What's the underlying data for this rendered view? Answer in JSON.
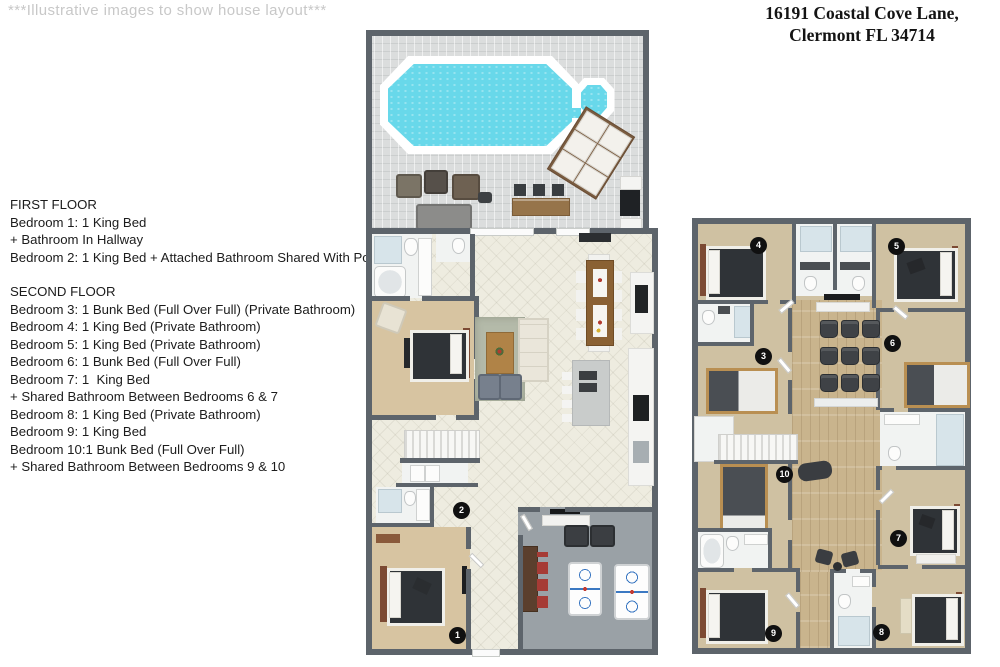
{
  "note": {
    "text": "***Illustrative images to show house layout***"
  },
  "address": {
    "line1": "16191 Coastal Cove Lane,",
    "line2": "Clermont FL 34714"
  },
  "legend": {
    "first_floor": {
      "title": "FIRST FLOOR",
      "lines": [
        "Bedroom 1: 1 King Bed",
        "+ Bathroom In Hallway",
        "Bedroom 2: 1 King Bed + Attached Bathroom Shared With Pool"
      ]
    },
    "second_floor": {
      "title": "SECOND FLOOR",
      "lines": [
        "Bedroom 3: 1 Bunk Bed (Full Over Full) (Private Bathroom)",
        "Bedroom 4: 1 King Bed (Private Bathroom)",
        "Bedroom 5: 1 King Bed (Private Bathroom)",
        "Bedroom 6: 1 Bunk Bed (Full Over Full)",
        "Bedroom 7: 1  King Bed",
        "+ Shared Bathroom Between Bedrooms 6 & 7",
        "Bedroom 8: 1 King Bed (Private Bathroom)",
        "Bedroom 9: 1 King Bed",
        "Bedroom 10:1 Bunk Bed (Full Over Full)",
        "+ Shared Bathroom Between Bedrooms 9 & 10"
      ]
    }
  },
  "floor1": {
    "badges": [
      "1",
      "2"
    ]
  },
  "floor2": {
    "badges": [
      "3",
      "4",
      "5",
      "6",
      "7",
      "8",
      "9",
      "10"
    ]
  },
  "colors": {
    "wall": "#5d646b",
    "pool_water": "#68d8ea",
    "deck_tile": "#dbdddd",
    "interior_tile": "#eeece0",
    "carpet": "#d7c4a1",
    "carpet_2f": "#cfc1a2",
    "wood_floor": "#c9b48d",
    "game_floor": "#9aa1a6",
    "bed_dark": "#2f3337",
    "headboard_wood": "#7c4a33",
    "bunk_wood": "#b98f52",
    "badge": "#101010",
    "accent_red": "#a63b35",
    "seat_dark": "#3f4246",
    "watermark_gray": "#c8c8c8",
    "text": "#1b1b1b"
  }
}
